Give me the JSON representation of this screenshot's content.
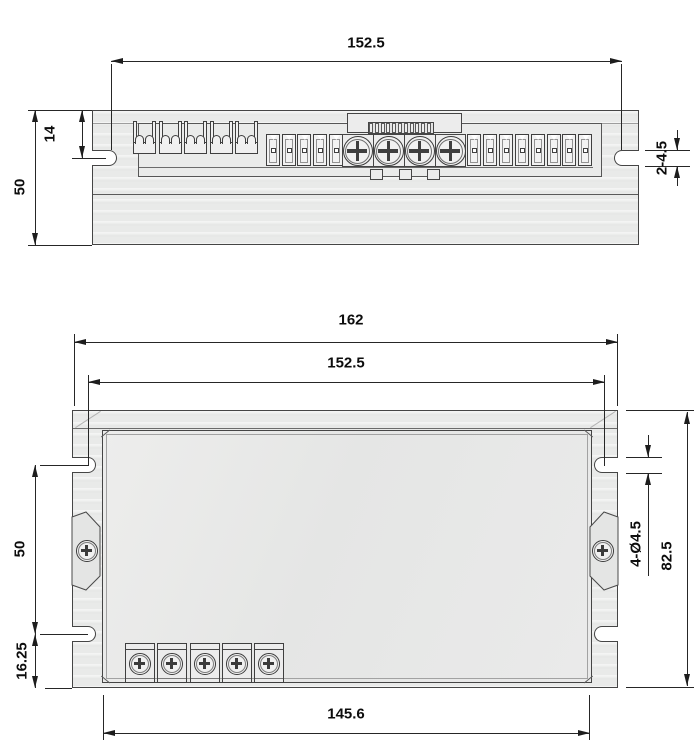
{
  "dimensions": {
    "top_view": {
      "mount_hole_span": "152.5",
      "slot_center_offset": "14",
      "body_height": "50",
      "slot_note": "2-4.5"
    },
    "front_view": {
      "overall_width": "162",
      "mount_hole_span": "152.5",
      "mount_hole_vertical_span": "50",
      "bottom_slot_offset": "16.25",
      "bottom_span": "145.6",
      "mount_hole_note": "4-Ø4.5",
      "overall_height": "82.5"
    }
  },
  "components": {
    "cage_terminals": 5,
    "left_pin_contacts": 5,
    "right_pin_contacts": 8,
    "adjust_screws": 4,
    "screw_dividers": 3,
    "dip_segments": 11,
    "feet_tabs": 3,
    "front_terminals": 5
  }
}
